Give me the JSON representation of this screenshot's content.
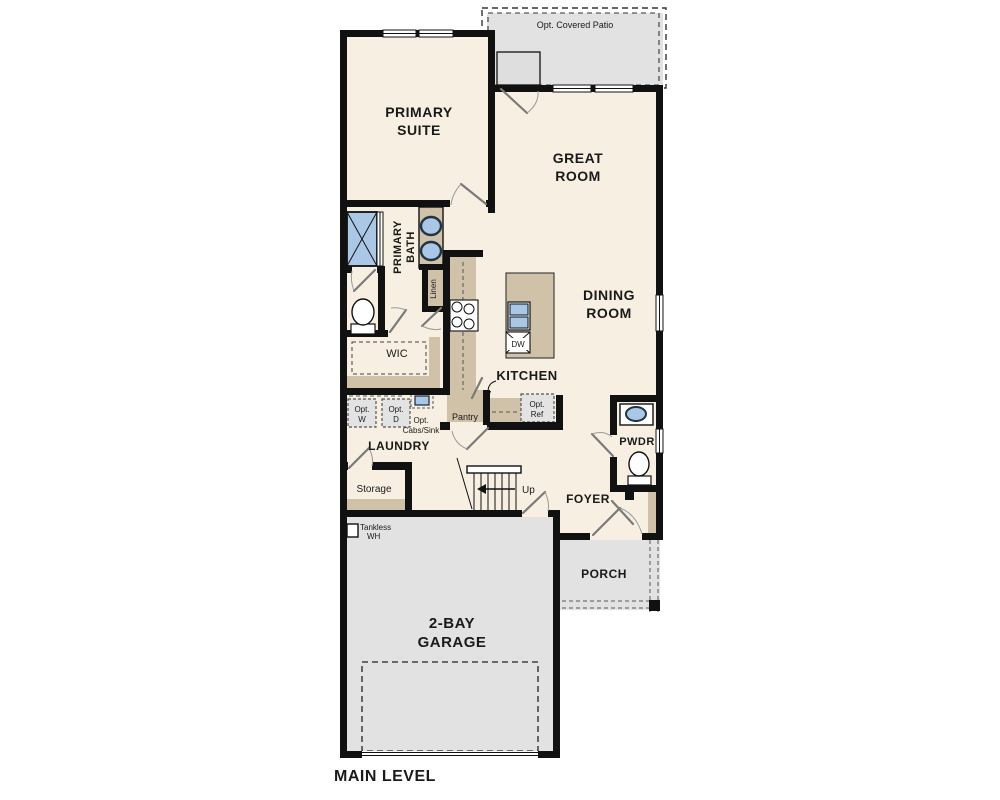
{
  "plan": {
    "title": "MAIN LEVEL",
    "rooms": {
      "patio": {
        "label": "Opt. Covered Patio"
      },
      "primary_suite": {
        "lines": [
          "PRIMARY",
          "SUITE"
        ]
      },
      "great_room": {
        "lines": [
          "GREAT",
          "ROOM"
        ]
      },
      "dining_room": {
        "lines": [
          "DINING",
          "ROOM"
        ]
      },
      "primary_bath": {
        "lines": [
          "PRIMARY",
          "BATH"
        ]
      },
      "wic": {
        "label": "WIC"
      },
      "kitchen": {
        "label": "KITCHEN"
      },
      "laundry": {
        "label": "LAUNDRY"
      },
      "storage": {
        "label": "Storage"
      },
      "pwdr": {
        "label": "PWDR"
      },
      "foyer": {
        "label": "FOYER"
      },
      "porch": {
        "label": "PORCH"
      },
      "garage": {
        "lines": [
          "2-BAY",
          "GARAGE"
        ]
      }
    },
    "annotations": {
      "linen": "Linen",
      "pantry": "Pantry",
      "dishwasher": "DW",
      "opt_ref": {
        "lines": [
          "Opt.",
          "Ref"
        ]
      },
      "opt_washer": {
        "lines": [
          "Opt.",
          "W"
        ]
      },
      "opt_dryer": {
        "lines": [
          "Opt.",
          "D"
        ]
      },
      "opt_cabs_sink": {
        "lines": [
          "Opt.",
          "Cabs/Sink"
        ]
      },
      "tankless_wh": {
        "lines": [
          "Tankless",
          "WH"
        ]
      },
      "stairs_up": "Up"
    },
    "colors": {
      "wall": "#111111",
      "room_fill": "#f7f0e2",
      "outdoor_fill": "#e2e2e2",
      "cabinet_fill": "#cfc2a9",
      "fixture_blue": "#aac7e6",
      "background": "#ffffff"
    }
  }
}
